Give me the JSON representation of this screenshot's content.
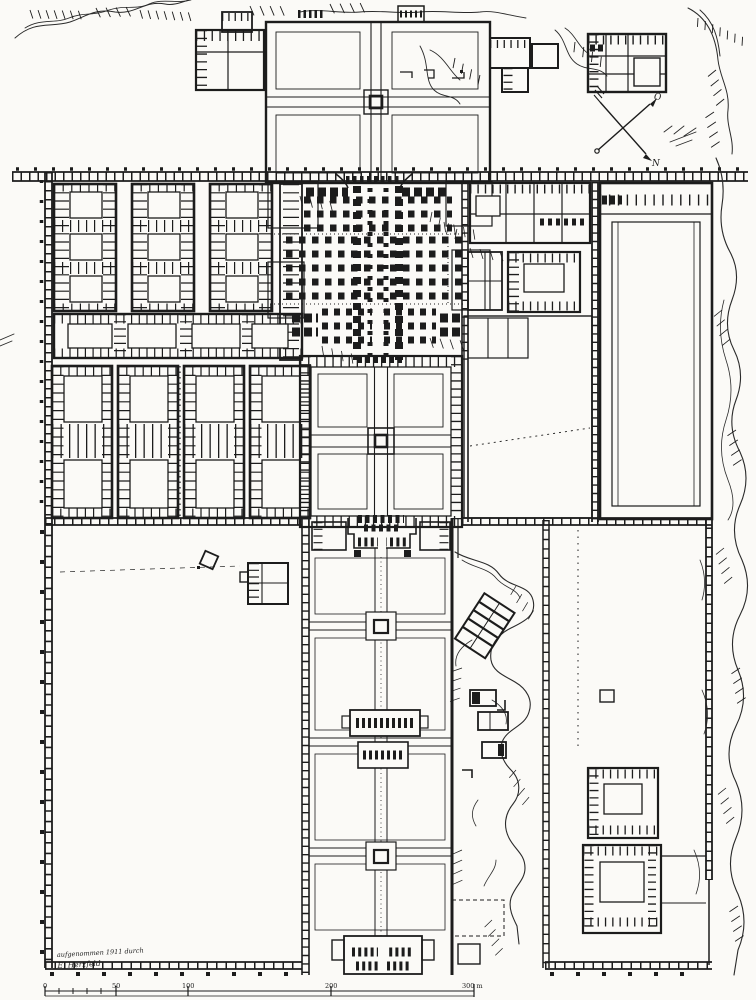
{
  "annotations": {
    "signature": {
      "line1": "aufgenommen 1911 durch",
      "line2": "E. Herzfeld"
    },
    "compass": {
      "north_label": "N",
      "east_label": "O"
    },
    "scale_bar": {
      "unit": "m",
      "tick_values": [
        0,
        50,
        100,
        200,
        300
      ],
      "labels": [
        "0",
        "50",
        "100",
        "200",
        "300 m"
      ]
    }
  },
  "colors": {
    "ink": "#1c1c1c",
    "paper": "#fbfaf7"
  }
}
